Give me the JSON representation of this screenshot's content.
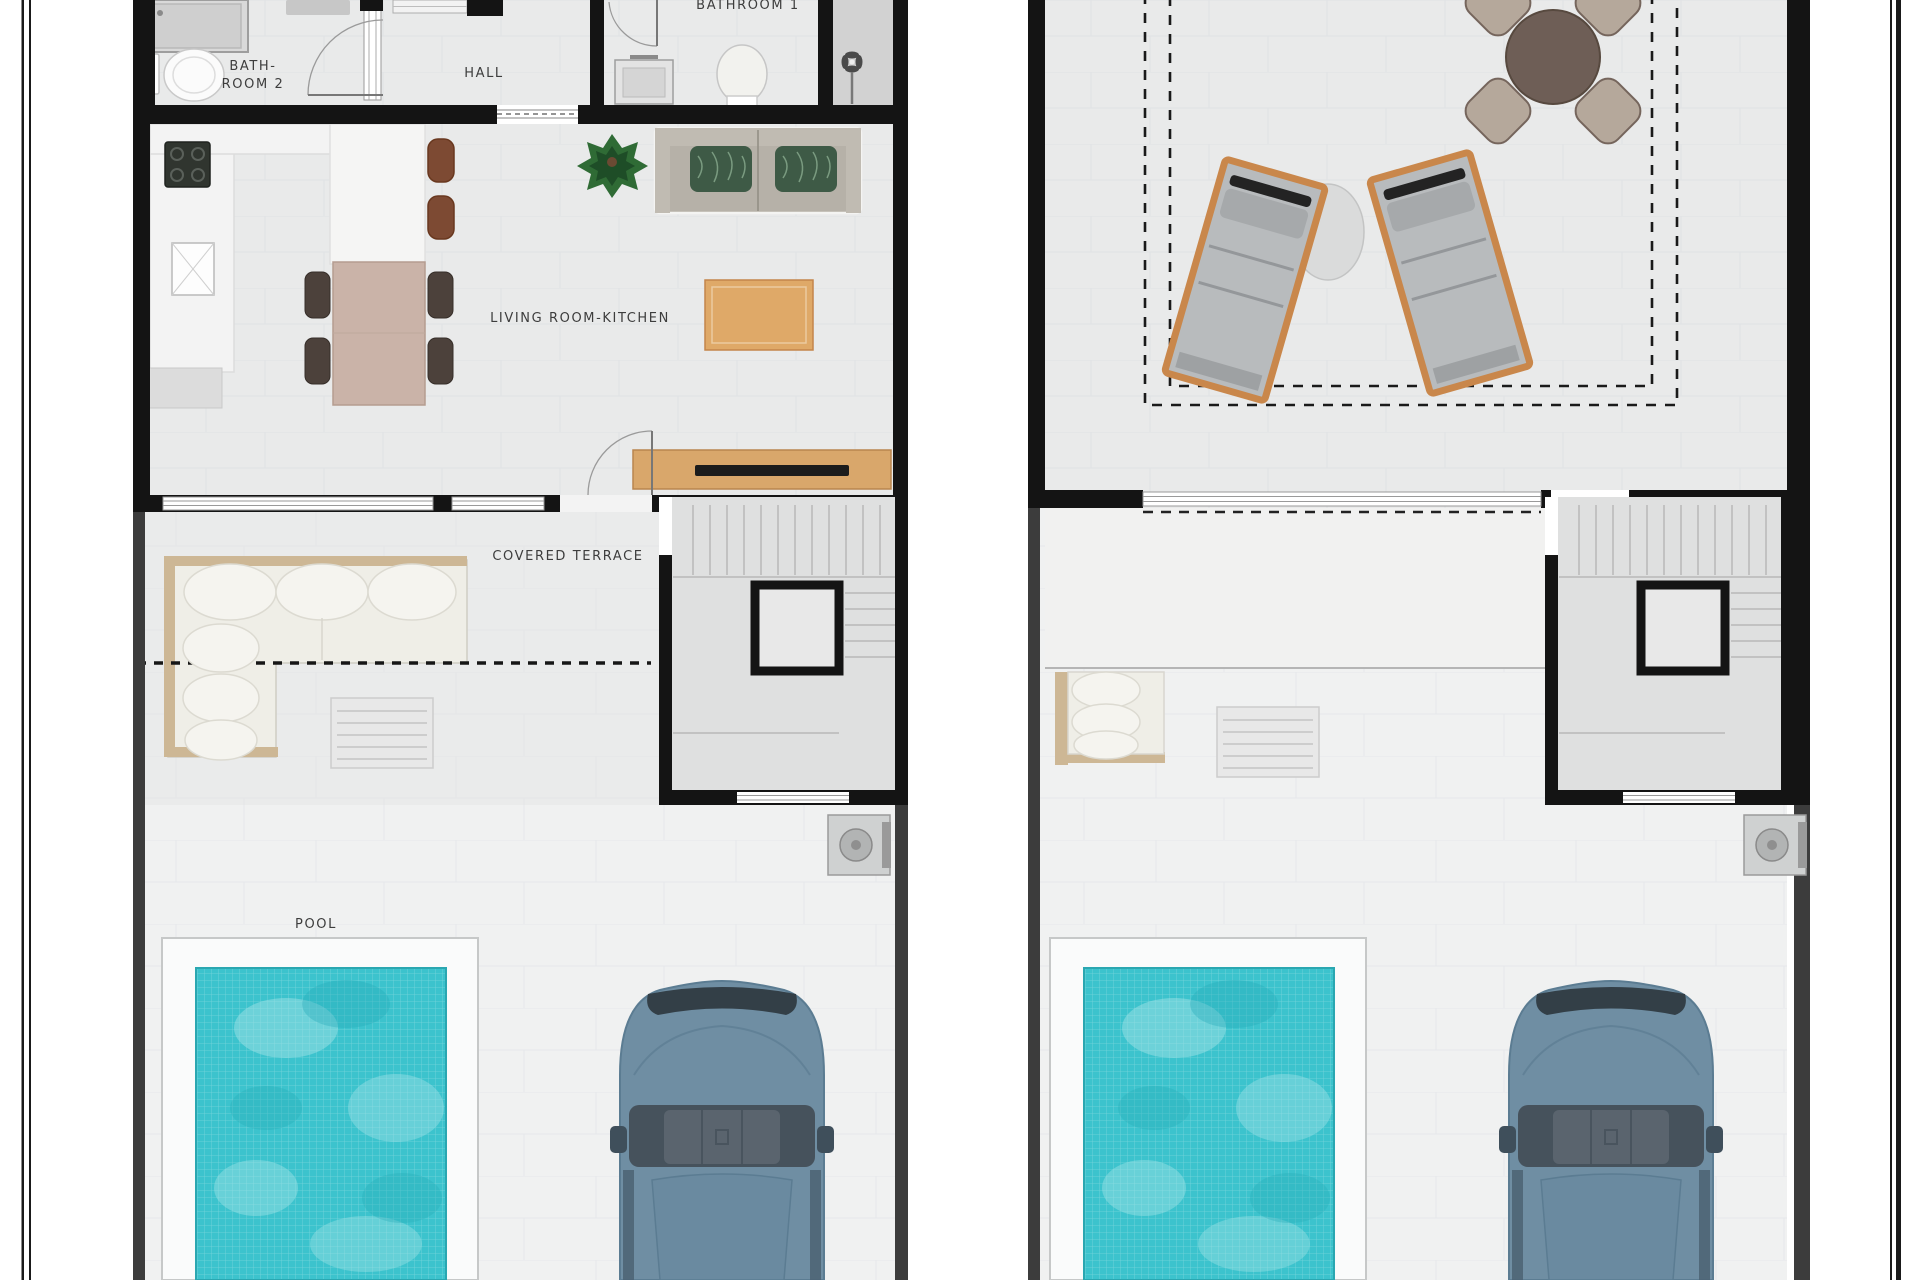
{
  "sheet": {
    "type_note": "architectural floor plan sheet, two plans side by side",
    "labels": {
      "bathroom2_line1": "BATH-",
      "bathroom2_line2": "ROOM 2",
      "hall": "HALL",
      "bathroom1": "BATHROOM 1",
      "living_room_kitchen": "LIVING ROOM-KITCHEN",
      "covered_terrace": "COVERED TERRACE",
      "pool": "POOL"
    },
    "icons": [
      "shower-icon",
      "toilet-icon",
      "sink-icon",
      "stove-icon",
      "kitchen-sink-icon",
      "dining-table-icon",
      "chair-icon",
      "stool-icon",
      "plant-icon",
      "sofa-icon",
      "pillow-icon",
      "coffee-table-icon",
      "tv-sideboard-icon",
      "door-swing-icon",
      "window-icon",
      "stairs-icon",
      "outdoor-sofa-icon",
      "slatted-table-icon",
      "pool-icon",
      "car-icon",
      "ac-unit-icon",
      "fan-icon",
      "sun-lounger-icon",
      "round-table-icon",
      "side-table-icon"
    ],
    "colors": {
      "wall": "#141414",
      "outdoor_boundary": "#3c3c3c",
      "floor_interior": "#e9eaea",
      "floor_outdoor": "#f0f1f1",
      "pool_water": "#3cc3cd",
      "pool_water_light": "#a8e4e8",
      "wood_accent": "#d9a76b",
      "sofa_frame_wood": "#cdb795",
      "lounger_frame": "#c9874b",
      "car_body": "#6f8ea3",
      "car_glass": "#46525c",
      "pillow_green": "#3e5a46",
      "chair_brown": "#4c413b",
      "stool_rust": "#7d4a33",
      "dining_table_beige": "#cab3a8",
      "round_table_brown": "#6e5e56",
      "terrace_chair_tan": "#b5a89b"
    }
  }
}
